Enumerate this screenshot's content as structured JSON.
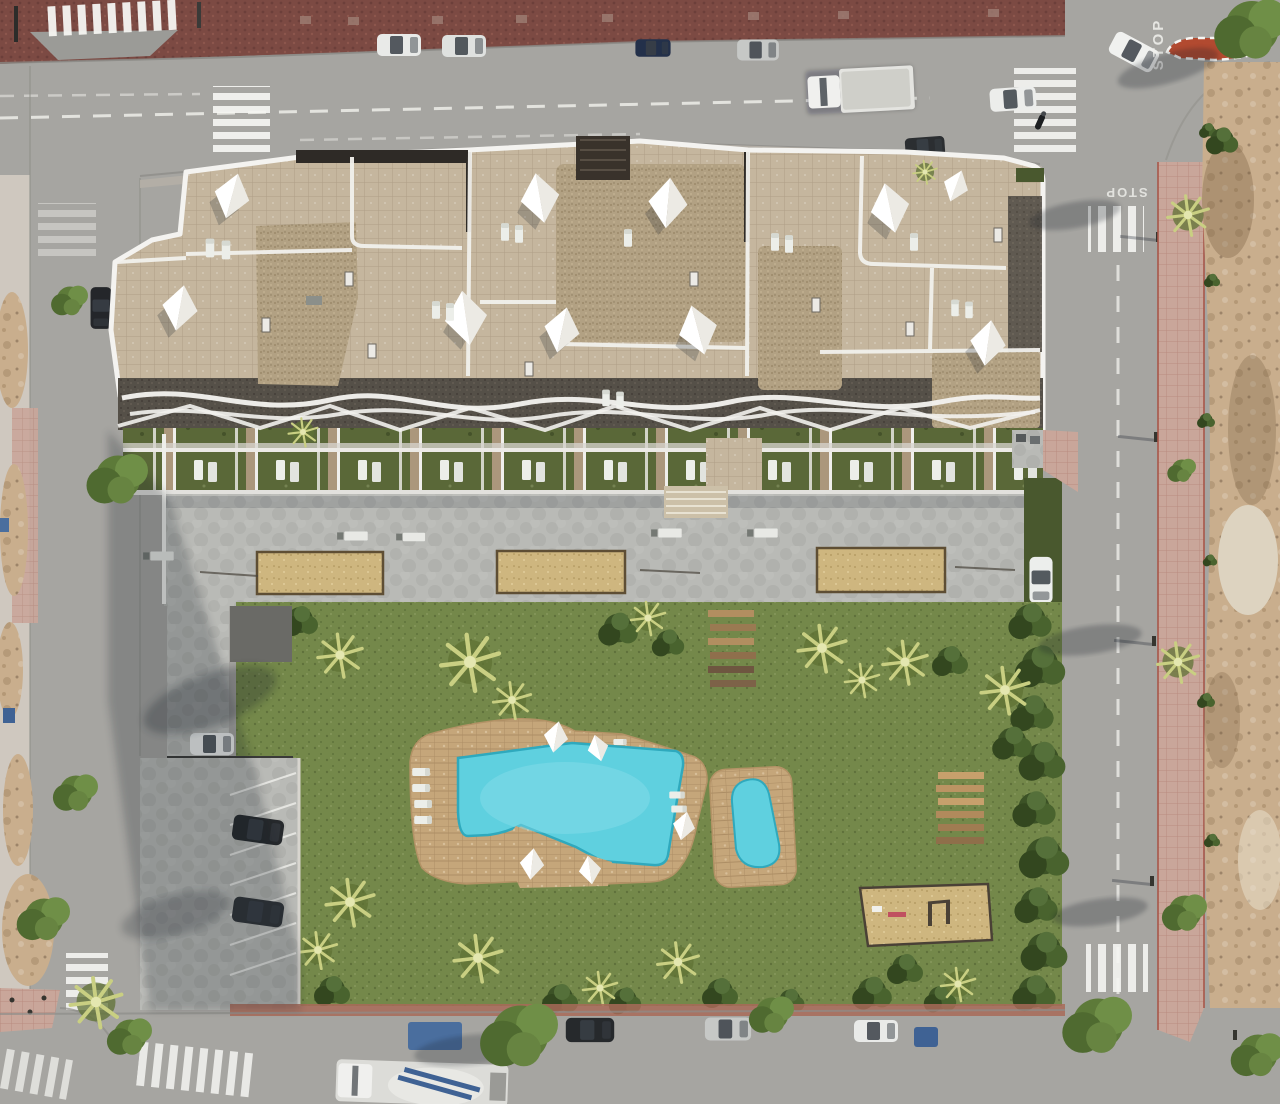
{
  "road_markings": {
    "stop_north": "STOP",
    "stop_mid": "STOP",
    "stop_south": "STOP"
  },
  "colors": {
    "road": "#a6a5a1",
    "road_light": "#b6b3ad",
    "sidewalk_red": "#7c4a43",
    "island_red": "#b24a30",
    "path_pink": "#c9a69a",
    "dirt": "#c9ae8d",
    "building_tile": "#c5b69e",
    "gravel_tan": "#b2a183",
    "gravel_dark": "#555048",
    "parapet_white": "#f4f3f0",
    "terrace_concrete": "#b9bab6",
    "lawn": "#74884a",
    "terrace_grass": "#5a6838",
    "hedge": "#3c5226",
    "pool_deck": "#c5a67a",
    "pool_water": "#5fd0df",
    "pool_rim": "#2fa9bd",
    "sand_court": "#ceb67f",
    "shade_sail": "#ffffff",
    "car_white": "#e9eae8",
    "car_dark": "#2b2e31",
    "dumpster_blue": "#4a6e9e",
    "palm_frond": "#c9cf82",
    "shadow": "#141c28"
  },
  "objects": {
    "building": "apartment-block-rooftop-terraces",
    "pool": "freeform-swimming-pool",
    "kids_pool": "small-teardrop-pool",
    "courts": "sand-petanque-courts",
    "playground": "sand-playground",
    "lot": "vacant-dirt-lot"
  }
}
